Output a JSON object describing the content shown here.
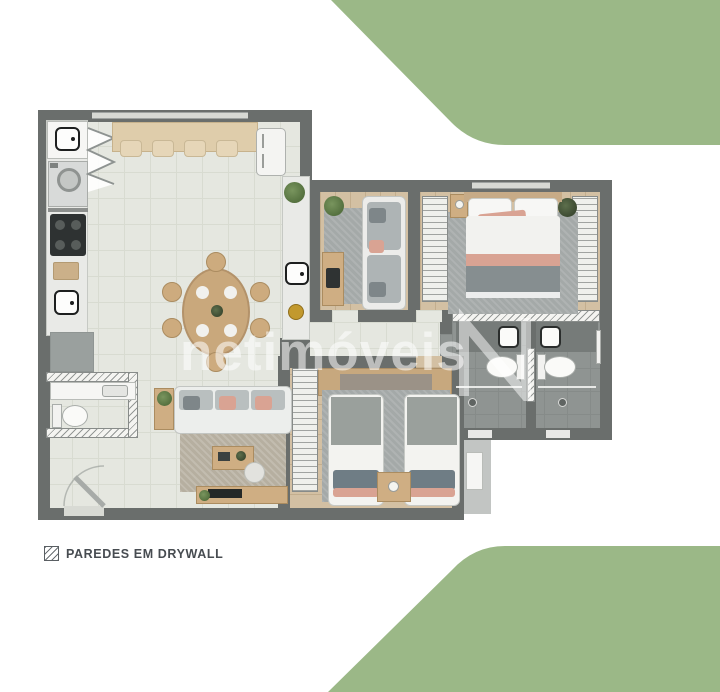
{
  "meta": {
    "title": "apartment-floor-plan-render",
    "width_px": 720,
    "height_px": 692
  },
  "watermark": {
    "text": "netimóveis",
    "logo_icon": "netimoveis-n-ribbon-logo"
  },
  "legend": {
    "label": "PAREDES EM DRYWALL",
    "symbol_icon": "drywall-hatch-square"
  },
  "colors": {
    "green": "#9bb887",
    "wall": "#6a6e6c",
    "tile": "#e5e7e0",
    "tile_line": "#d8dbd1",
    "wood": "#d3c0a3",
    "wood_line": "#c3ae8e",
    "bath_floor": "#8f9492",
    "bath_line": "#868b89",
    "rug_gray": "#a4a9a8",
    "rug_beige": "#b6afa0",
    "wood_furn": "#cfae83",
    "salmon": "#d9a393",
    "cushion": "#7e8689",
    "watermark": "rgba(255,255,255,0.55)",
    "legend_text": "#474c51"
  },
  "fixtures": [
    "kitchen-sink",
    "laundry-sink",
    "washing-machine",
    "cooktop",
    "fridge",
    "breakfast-bar",
    "bar-stool",
    "dining-table",
    "dining-chair",
    "double-bed",
    "single-bed",
    "twin-beds",
    "wardrobe-closet",
    "nightstand",
    "sofa",
    "office-desk",
    "tv-console",
    "coffee-table",
    "toilet",
    "bathroom-sink",
    "shower",
    "towel-bar",
    "entry-door",
    "potted-plant",
    "area-rug"
  ]
}
